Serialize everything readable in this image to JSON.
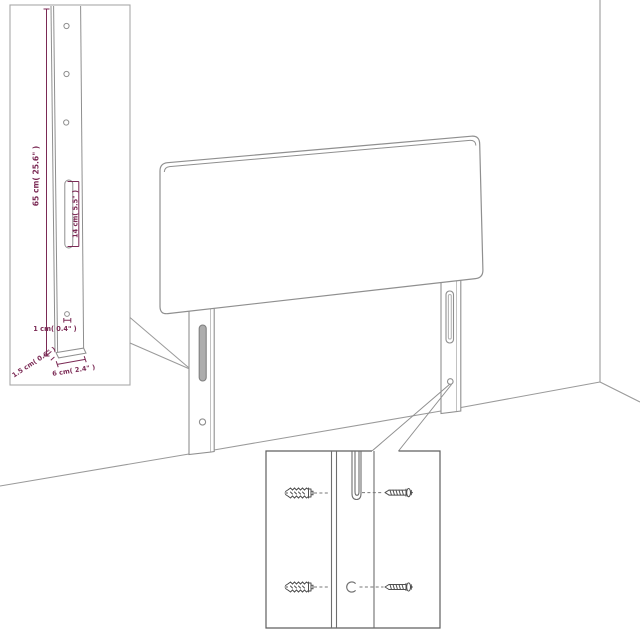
{
  "diagram": {
    "kind": "headboard-dimension-diagram",
    "scene_parts": [
      "headboard-panel",
      "left-leg",
      "right-leg",
      "wall-corner",
      "floor"
    ],
    "colors": {
      "furniture_line": "#8f8f8f",
      "inset_border_light": "#a8a8a8",
      "inset_border_dark": "#5f5f5f",
      "hardware_line": "#4f4f4f",
      "dimension": "#7b2a55",
      "slot_fill": "#adadad",
      "background": "#ffffff"
    },
    "labels": {
      "leg_height": "65 cm( 25.6\" )",
      "slot_length": "14 cm( 5.5\" )",
      "hole_diameter": "1 cm( 0.4\" )",
      "leg_thickness": "1.5 cm( 0.6\" )",
      "leg_width": "6 cm( 2.4\" )"
    },
    "insets": {
      "leg_detail": {
        "shows": "full leg with three screw holes, mounting slot and bottom hole",
        "icons": [
          "screw-hole",
          "mounting-slot"
        ]
      },
      "mounting_detail": {
        "shows": "wall plugs and screws aligned with leg slot and hole",
        "icons": [
          "wall-plug",
          "screw",
          "mounting-slot",
          "screw-hole"
        ]
      }
    }
  }
}
